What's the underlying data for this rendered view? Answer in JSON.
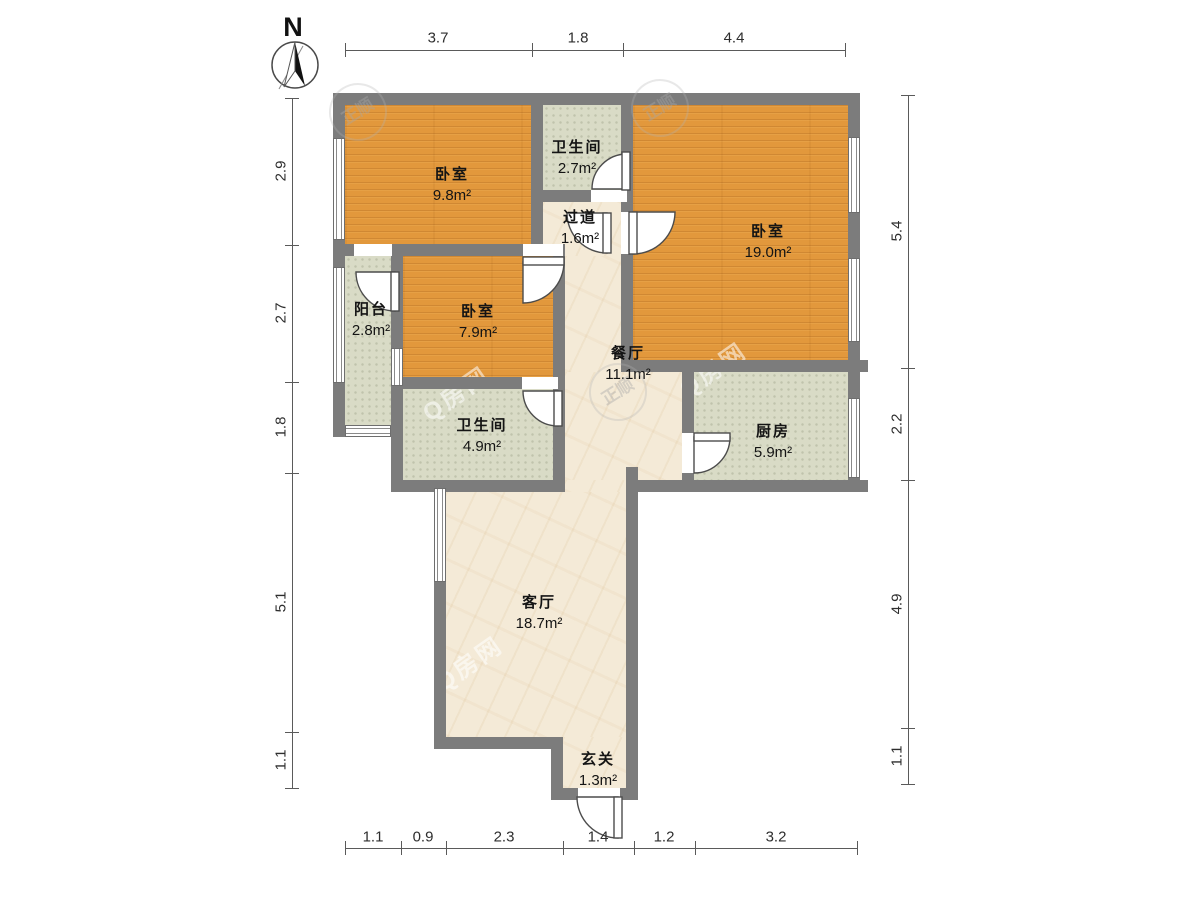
{
  "compass": {
    "label": "N"
  },
  "rooms": {
    "bedroom1": {
      "name": "卧室",
      "area": "9.8m²"
    },
    "bathroom1": {
      "name": "卫生间",
      "area": "2.7m²"
    },
    "hallway": {
      "name": "过道",
      "area": "1.6m²"
    },
    "bedroom2": {
      "name": "卧室",
      "area": "19.0m²"
    },
    "balcony": {
      "name": "阳台",
      "area": "2.8m²"
    },
    "bedroom3": {
      "name": "卧室",
      "area": "7.9m²"
    },
    "dining": {
      "name": "餐厅",
      "area": "11.1m²"
    },
    "bathroom2": {
      "name": "卫生间",
      "area": "4.9m²"
    },
    "kitchen": {
      "name": "厨房",
      "area": "5.9m²"
    },
    "living": {
      "name": "客厅",
      "area": "18.7m²"
    },
    "entry": {
      "name": "玄关",
      "area": "1.3m²"
    }
  },
  "dims": {
    "top": [
      "3.7",
      "1.8",
      "4.4"
    ],
    "left": [
      "2.9",
      "2.7",
      "1.8",
      "5.1",
      "1.1"
    ],
    "right": [
      "5.4",
      "2.2",
      "4.9",
      "1.1"
    ],
    "bottom": [
      "1.1",
      "0.9",
      "2.3",
      "1.4",
      "1.2",
      "3.2"
    ]
  },
  "watermark": {
    "brand": "Q房网",
    "stamp": "正顺"
  },
  "colors": {
    "wood": "#e2983c",
    "tile": "#d9dbc6",
    "marble": "#f4ead7",
    "wall": "#7c7c7c"
  }
}
